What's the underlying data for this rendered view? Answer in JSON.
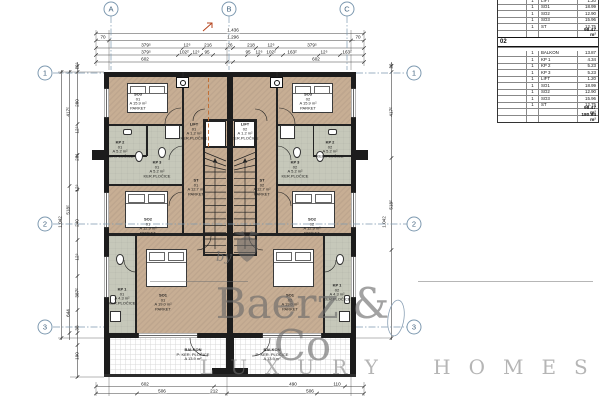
{
  "table": {
    "section01": {
      "rows": [
        {
          "qty": "1",
          "name": "LIFT",
          "value": "1.20"
        },
        {
          "qty": "1",
          "name": "SO1",
          "value": "18.99"
        },
        {
          "qty": "1",
          "name": "SO2",
          "value": "12.90"
        },
        {
          "qty": "1",
          "name": "SO3",
          "value": "15.96"
        },
        {
          "qty": "1",
          "name": "ST",
          "value": "12.75"
        }
      ],
      "total": "98.47 m²"
    },
    "section02": {
      "header": "02",
      "rows": [
        {
          "qty": "1",
          "name": "BALKON",
          "value": "13.87"
        },
        {
          "qty": "1",
          "name": "KP 1",
          "value": "4.34"
        },
        {
          "qty": "1",
          "name": "KP 2",
          "value": "5.23"
        },
        {
          "qty": "1",
          "name": "KP 3",
          "value": "5.23"
        },
        {
          "qty": "1",
          "name": "LIFT",
          "value": "1.20"
        },
        {
          "qty": "1",
          "name": "SO1",
          "value": "18.99"
        },
        {
          "qty": "1",
          "name": "SO2",
          "value": "12.90"
        },
        {
          "qty": "1",
          "name": "SO3",
          "value": "15.96"
        },
        {
          "qty": "1",
          "name": "ST",
          "value": "12.75"
        }
      ],
      "total": "98.47 m²"
    },
    "grand_total": "180.94 m²"
  },
  "grid": {
    "top": [
      "A",
      "B",
      "C"
    ],
    "left": [
      "1",
      "2",
      "3"
    ],
    "right": [
      "1",
      "2",
      "3"
    ]
  },
  "dims": {
    "top": [
      {
        "x": 233,
        "y": 31,
        "t": "1.436"
      },
      {
        "x": 103,
        "y": 38,
        "t": "70"
      },
      {
        "x": 233,
        "y": 38,
        "t": "1.296"
      },
      {
        "x": 358,
        "y": 38,
        "t": "70"
      },
      {
        "x": 146,
        "y": 45.5,
        "t": "379⁵"
      },
      {
        "x": 187,
        "y": 45.5,
        "t": "12⁵"
      },
      {
        "x": 208,
        "y": 45.5,
        "t": "216"
      },
      {
        "x": 230,
        "y": 45.5,
        "t": "26"
      },
      {
        "x": 251,
        "y": 45.5,
        "t": "218"
      },
      {
        "x": 271,
        "y": 45.5,
        "t": "12⁵"
      },
      {
        "x": 312,
        "y": 45.5,
        "t": "379⁵"
      },
      {
        "x": 146,
        "y": 52.5,
        "t": "379⁵"
      },
      {
        "x": 184,
        "y": 52.5,
        "t": "102²"
      },
      {
        "x": 196,
        "y": 52.5,
        "t": "12⁵"
      },
      {
        "x": 207,
        "y": 52.5,
        "t": "95"
      },
      {
        "x": 248,
        "y": 52.5,
        "t": "95"
      },
      {
        "x": 259,
        "y": 52.5,
        "t": "12⁵"
      },
      {
        "x": 271,
        "y": 52.5,
        "t": "102²"
      },
      {
        "x": 292,
        "y": 52.5,
        "t": "163²"
      },
      {
        "x": 324,
        "y": 52.5,
        "t": "12⁵"
      },
      {
        "x": 347,
        "y": 52.5,
        "t": "163²"
      },
      {
        "x": 145,
        "y": 59.5,
        "t": "602"
      },
      {
        "x": 316,
        "y": 59.5,
        "t": "602"
      }
    ],
    "bottom": [
      {
        "x": 145,
        "y": 384.5,
        "t": "602"
      },
      {
        "x": 293,
        "y": 384.5,
        "t": "490"
      },
      {
        "x": 337,
        "y": 384.5,
        "t": "110"
      },
      {
        "x": 162,
        "y": 391.5,
        "t": "506"
      },
      {
        "x": 214,
        "y": 391.5,
        "t": "212"
      },
      {
        "x": 310,
        "y": 391.5,
        "t": "506"
      }
    ],
    "left": [
      {
        "x": 78,
        "y": 66,
        "t": "12⁵"
      },
      {
        "x": 78,
        "y": 103,
        "t": "280"
      },
      {
        "x": 78,
        "y": 130,
        "t": "12⁵"
      },
      {
        "x": 78,
        "y": 157,
        "t": "281"
      },
      {
        "x": 78,
        "y": 188,
        "t": "12⁵"
      },
      {
        "x": 78,
        "y": 223,
        "t": "240"
      },
      {
        "x": 78,
        "y": 257,
        "t": "12⁵"
      },
      {
        "x": 78,
        "y": 293,
        "t": "387²"
      },
      {
        "x": 78,
        "y": 328,
        "t": "38"
      },
      {
        "x": 78,
        "y": 356,
        "t": "190"
      },
      {
        "x": 69,
        "y": 112,
        "t": "417²"
      },
      {
        "x": 69,
        "y": 210,
        "t": "518²"
      },
      {
        "x": 69,
        "y": 313,
        "t": "644"
      },
      {
        "x": 61,
        "y": 222,
        "t": "1.042"
      }
    ],
    "right": [
      {
        "x": 392,
        "y": 66,
        "t": "26"
      },
      {
        "x": 392,
        "y": 112,
        "t": "417²"
      },
      {
        "x": 392,
        "y": 205,
        "t": "518²"
      },
      {
        "x": 385,
        "y": 222,
        "t": "1.042"
      }
    ]
  },
  "room_labels": [
    {
      "id": "so3-01",
      "cx": 138,
      "cy": 102,
      "lines": [
        "SO3",
        "01",
        "A 15.9 m²",
        "PARKET"
      ]
    },
    {
      "id": "so3-02",
      "cx": 308,
      "cy": 102,
      "lines": [
        "SO3",
        "02",
        "A 15.9 m²",
        "PARKET"
      ]
    },
    {
      "id": "lift-01",
      "cx": 194,
      "cy": 132,
      "lines": [
        "LIFT",
        "01",
        "A 1.2 m²",
        "KER.PLOČICE"
      ]
    },
    {
      "id": "lift-02",
      "cx": 245,
      "cy": 132,
      "lines": [
        "LIFT",
        "02",
        "A 1.2 m²",
        "KER.PLOČICE"
      ]
    },
    {
      "id": "kp2-01",
      "cx": 120,
      "cy": 150,
      "lines": [
        "KP 2",
        "01",
        "A 5.2 m²",
        "KER.PLOČICE"
      ]
    },
    {
      "id": "kp3-01",
      "cx": 157,
      "cy": 170,
      "lines": [
        "KP 3",
        "01",
        "A 5.2 m²",
        "KER.PLOČICE"
      ]
    },
    {
      "id": "kp2-02",
      "cx": 330,
      "cy": 150,
      "lines": [
        "KP 2",
        "02",
        "A 5.2 m²",
        "KER.PLOČICE"
      ]
    },
    {
      "id": "kp3-02",
      "cx": 295,
      "cy": 170,
      "lines": [
        "KP 3",
        "02",
        "A 5.2 m²",
        "KER.PLOČICE"
      ]
    },
    {
      "id": "st-01",
      "cx": 196,
      "cy": 188,
      "lines": [
        "ST",
        "01",
        "A 12.7 m²",
        "PARKET"
      ]
    },
    {
      "id": "st-02",
      "cx": 262,
      "cy": 188,
      "lines": [
        "ST",
        "02",
        "A 12.7 m²",
        "PARKET"
      ]
    },
    {
      "id": "so2-01",
      "cx": 148,
      "cy": 227,
      "lines": [
        "SO2",
        "01",
        "A 12.9 m²",
        "PARKET"
      ]
    },
    {
      "id": "so2-02",
      "cx": 312,
      "cy": 227,
      "lines": [
        "SO2",
        "02",
        "A 12.9 m²",
        "PARKET"
      ]
    },
    {
      "id": "kp1-01",
      "cx": 122,
      "cy": 297,
      "lines": [
        "KP 1",
        "01",
        "A 4.3 m²",
        "KER.PLOČICE"
      ]
    },
    {
      "id": "kp1-02",
      "cx": 337,
      "cy": 293,
      "lines": [
        "KP 1",
        "02",
        "A 4.3 m²",
        "KER.PLOČICE"
      ]
    },
    {
      "id": "so1-01",
      "cx": 163,
      "cy": 303,
      "lines": [
        "SO1",
        "01",
        "A 19.0 m²",
        "PARKET"
      ]
    },
    {
      "id": "so1-02",
      "cx": 290,
      "cy": 303,
      "lines": [
        "SO1",
        "02",
        "A 19.0 m²",
        "PARKET"
      ]
    },
    {
      "id": "balkon-01",
      "cx": 193,
      "cy": 355,
      "lines": [
        "BALKON",
        "P: KER. PLOČICE",
        "A 13.9 m²"
      ]
    },
    {
      "id": "balkon-02",
      "cx": 272,
      "cy": 355,
      "lines": [
        "BALKON",
        "P: KER. PLOČICE",
        "A 13.9 m²"
      ]
    }
  ],
  "watermark": {
    "by": "by",
    "brand": "Baerz & Co",
    "tagline": "LUXURY HOMES"
  }
}
